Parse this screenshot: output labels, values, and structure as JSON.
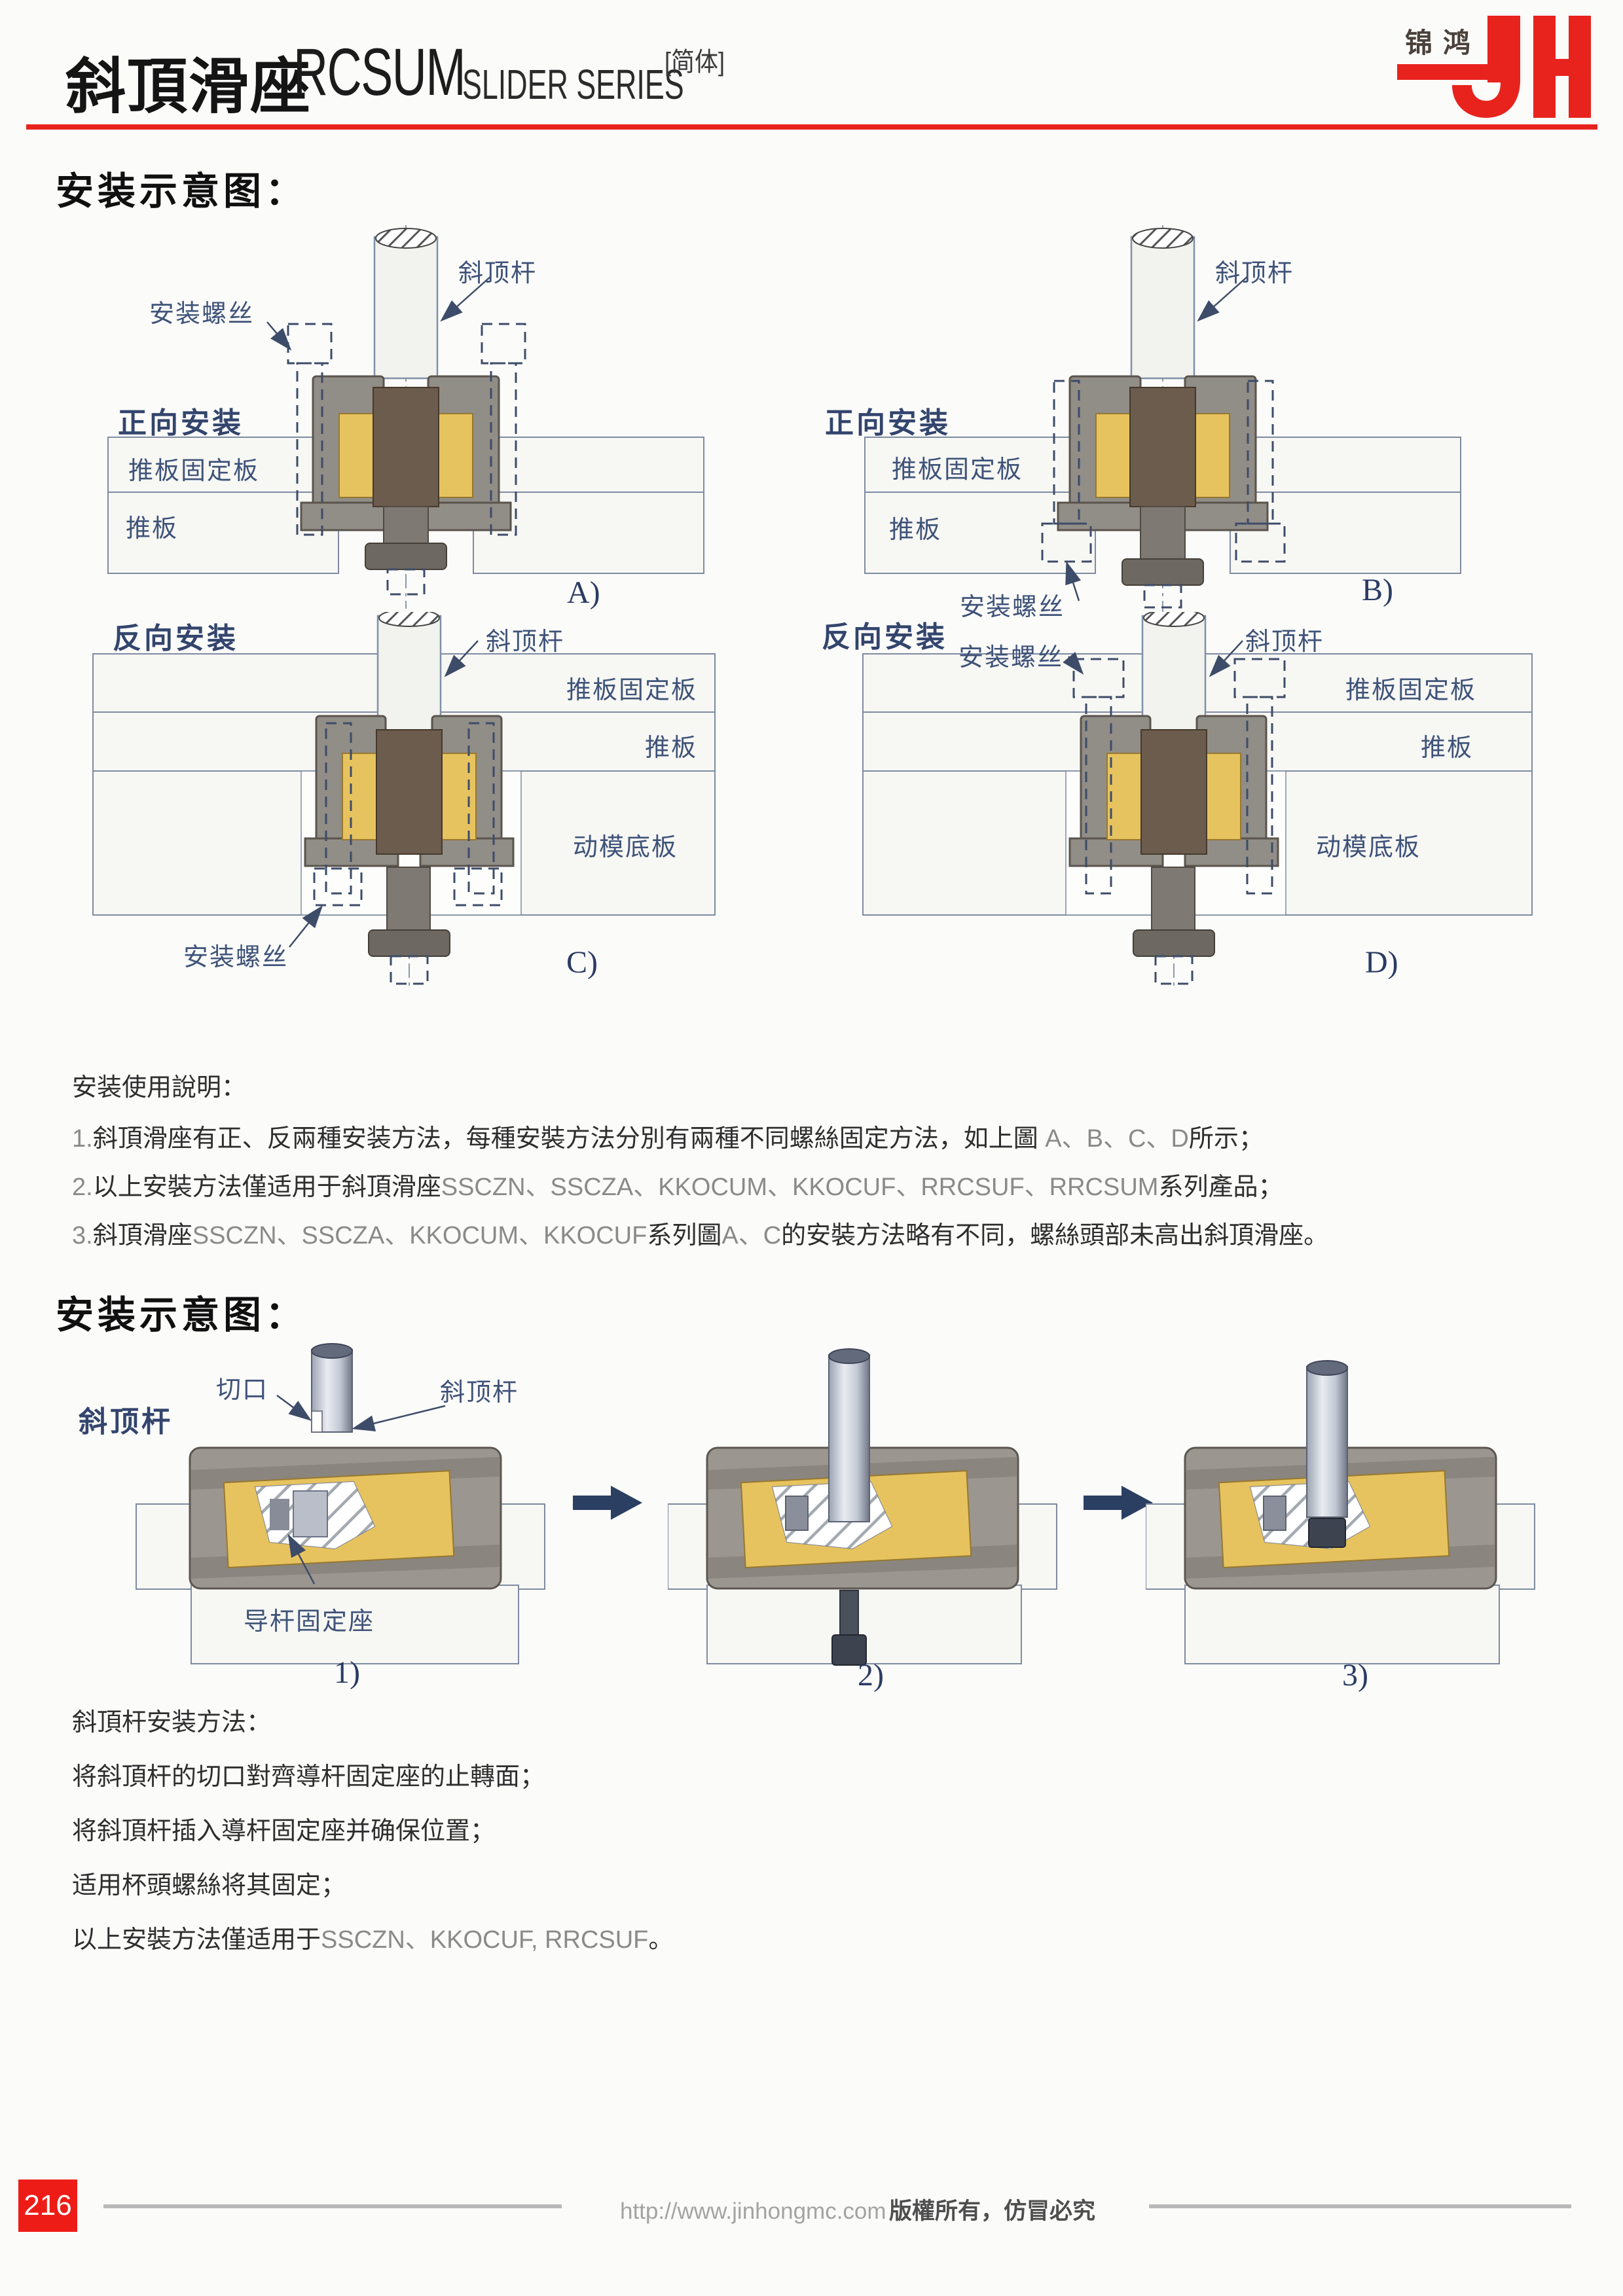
{
  "header": {
    "title_zh": "斜頂滑座",
    "title_code": "RCSUM",
    "title_series": "SLIDER SERIES",
    "title_note": "[简体]",
    "logo": {
      "cn": "锦鸿",
      "latin": "JH",
      "color": "#e8231d"
    },
    "rule_color": "#e8231d"
  },
  "colors": {
    "accent_red": "#e8231d",
    "label_blue": "#3f5379",
    "tag_blue": "#2b3c63",
    "plate_fill": "#f7f7f4",
    "body_gray": "#918d87",
    "insert_yellow": "#e7c35f",
    "core_brown": "#6b5c4d"
  },
  "section1": {
    "heading": "安装示意图："
  },
  "diagram_a": {
    "orientation": "正向安装",
    "rod": "斜顶杆",
    "screw": "安装螺丝",
    "plate1": "推板固定板",
    "plate2": "推板",
    "tag": "A)"
  },
  "diagram_b": {
    "orientation": "正向安装",
    "rod": "斜顶杆",
    "screw": "安装螺丝",
    "plate1": "推板固定板",
    "plate2": "推板",
    "tag": "B)"
  },
  "diagram_c": {
    "orientation": "反向安装",
    "rod": "斜顶杆",
    "screw": "安装螺丝",
    "plate1": "推板固定板",
    "plate2": "推板",
    "plate3": "动模底板",
    "tag": "C)"
  },
  "diagram_d": {
    "orientation": "反向安装",
    "rod": "斜顶杆",
    "screw": "安装螺丝",
    "plate1": "推板固定板",
    "plate2": "推板",
    "plate3": "动模底板",
    "tag": "D)"
  },
  "notes1": {
    "heading": "安装使用說明：",
    "l1_no": "1.",
    "l1_a": "斜頂滑座有正、反兩種安装方法，每種安裝方法分別有兩種不同螺絲固定方法，如上圖 ",
    "l1_b": "A、B、C、D",
    "l1_c": "所示；",
    "l2_no": "2.",
    "l2_a": "以上安裝方法僅适用于斜頂滑座",
    "l2_b": "SSCZN、SSCZA、KKOCUM、KKOCUF、RRCSUF、RRCSUM",
    "l2_c": "系列產品；",
    "l3_no": "3.",
    "l3_a": "斜頂滑座",
    "l3_b": "SSCZN、SSCZA、KKOCUM、KKOCUF",
    "l3_c": "系列圖",
    "l3_d": "A、C",
    "l3_e": "的安裝方法略有不同，螺絲頭部未高出斜頂滑座。"
  },
  "section2": {
    "heading": "安装示意图：",
    "side_label": "斜顶杆"
  },
  "steps": {
    "step1": {
      "cut": "切口",
      "rod": "斜顶杆",
      "seat": "导杆固定座",
      "tag": "1)"
    },
    "step2": {
      "tag": "2)"
    },
    "step3": {
      "tag": "3)"
    }
  },
  "notes2": {
    "heading": "斜頂杆安装方法：",
    "l1": "将斜頂杆的切口對齊導杆固定座的止轉面；",
    "l2": "将斜頂杆插入導杆固定座并确保位置；",
    "l3": "适用杯頭螺絲将其固定；",
    "l4_a": "以上安裝方法僅适用于",
    "l4_b": "SSCZN、KKOCUF, RRCSUF",
    "l4_c": "。"
  },
  "footer": {
    "page_no": "216",
    "url": "http://www.jinhongmc.com",
    "copyright": "版權所有，仿冒必究"
  }
}
